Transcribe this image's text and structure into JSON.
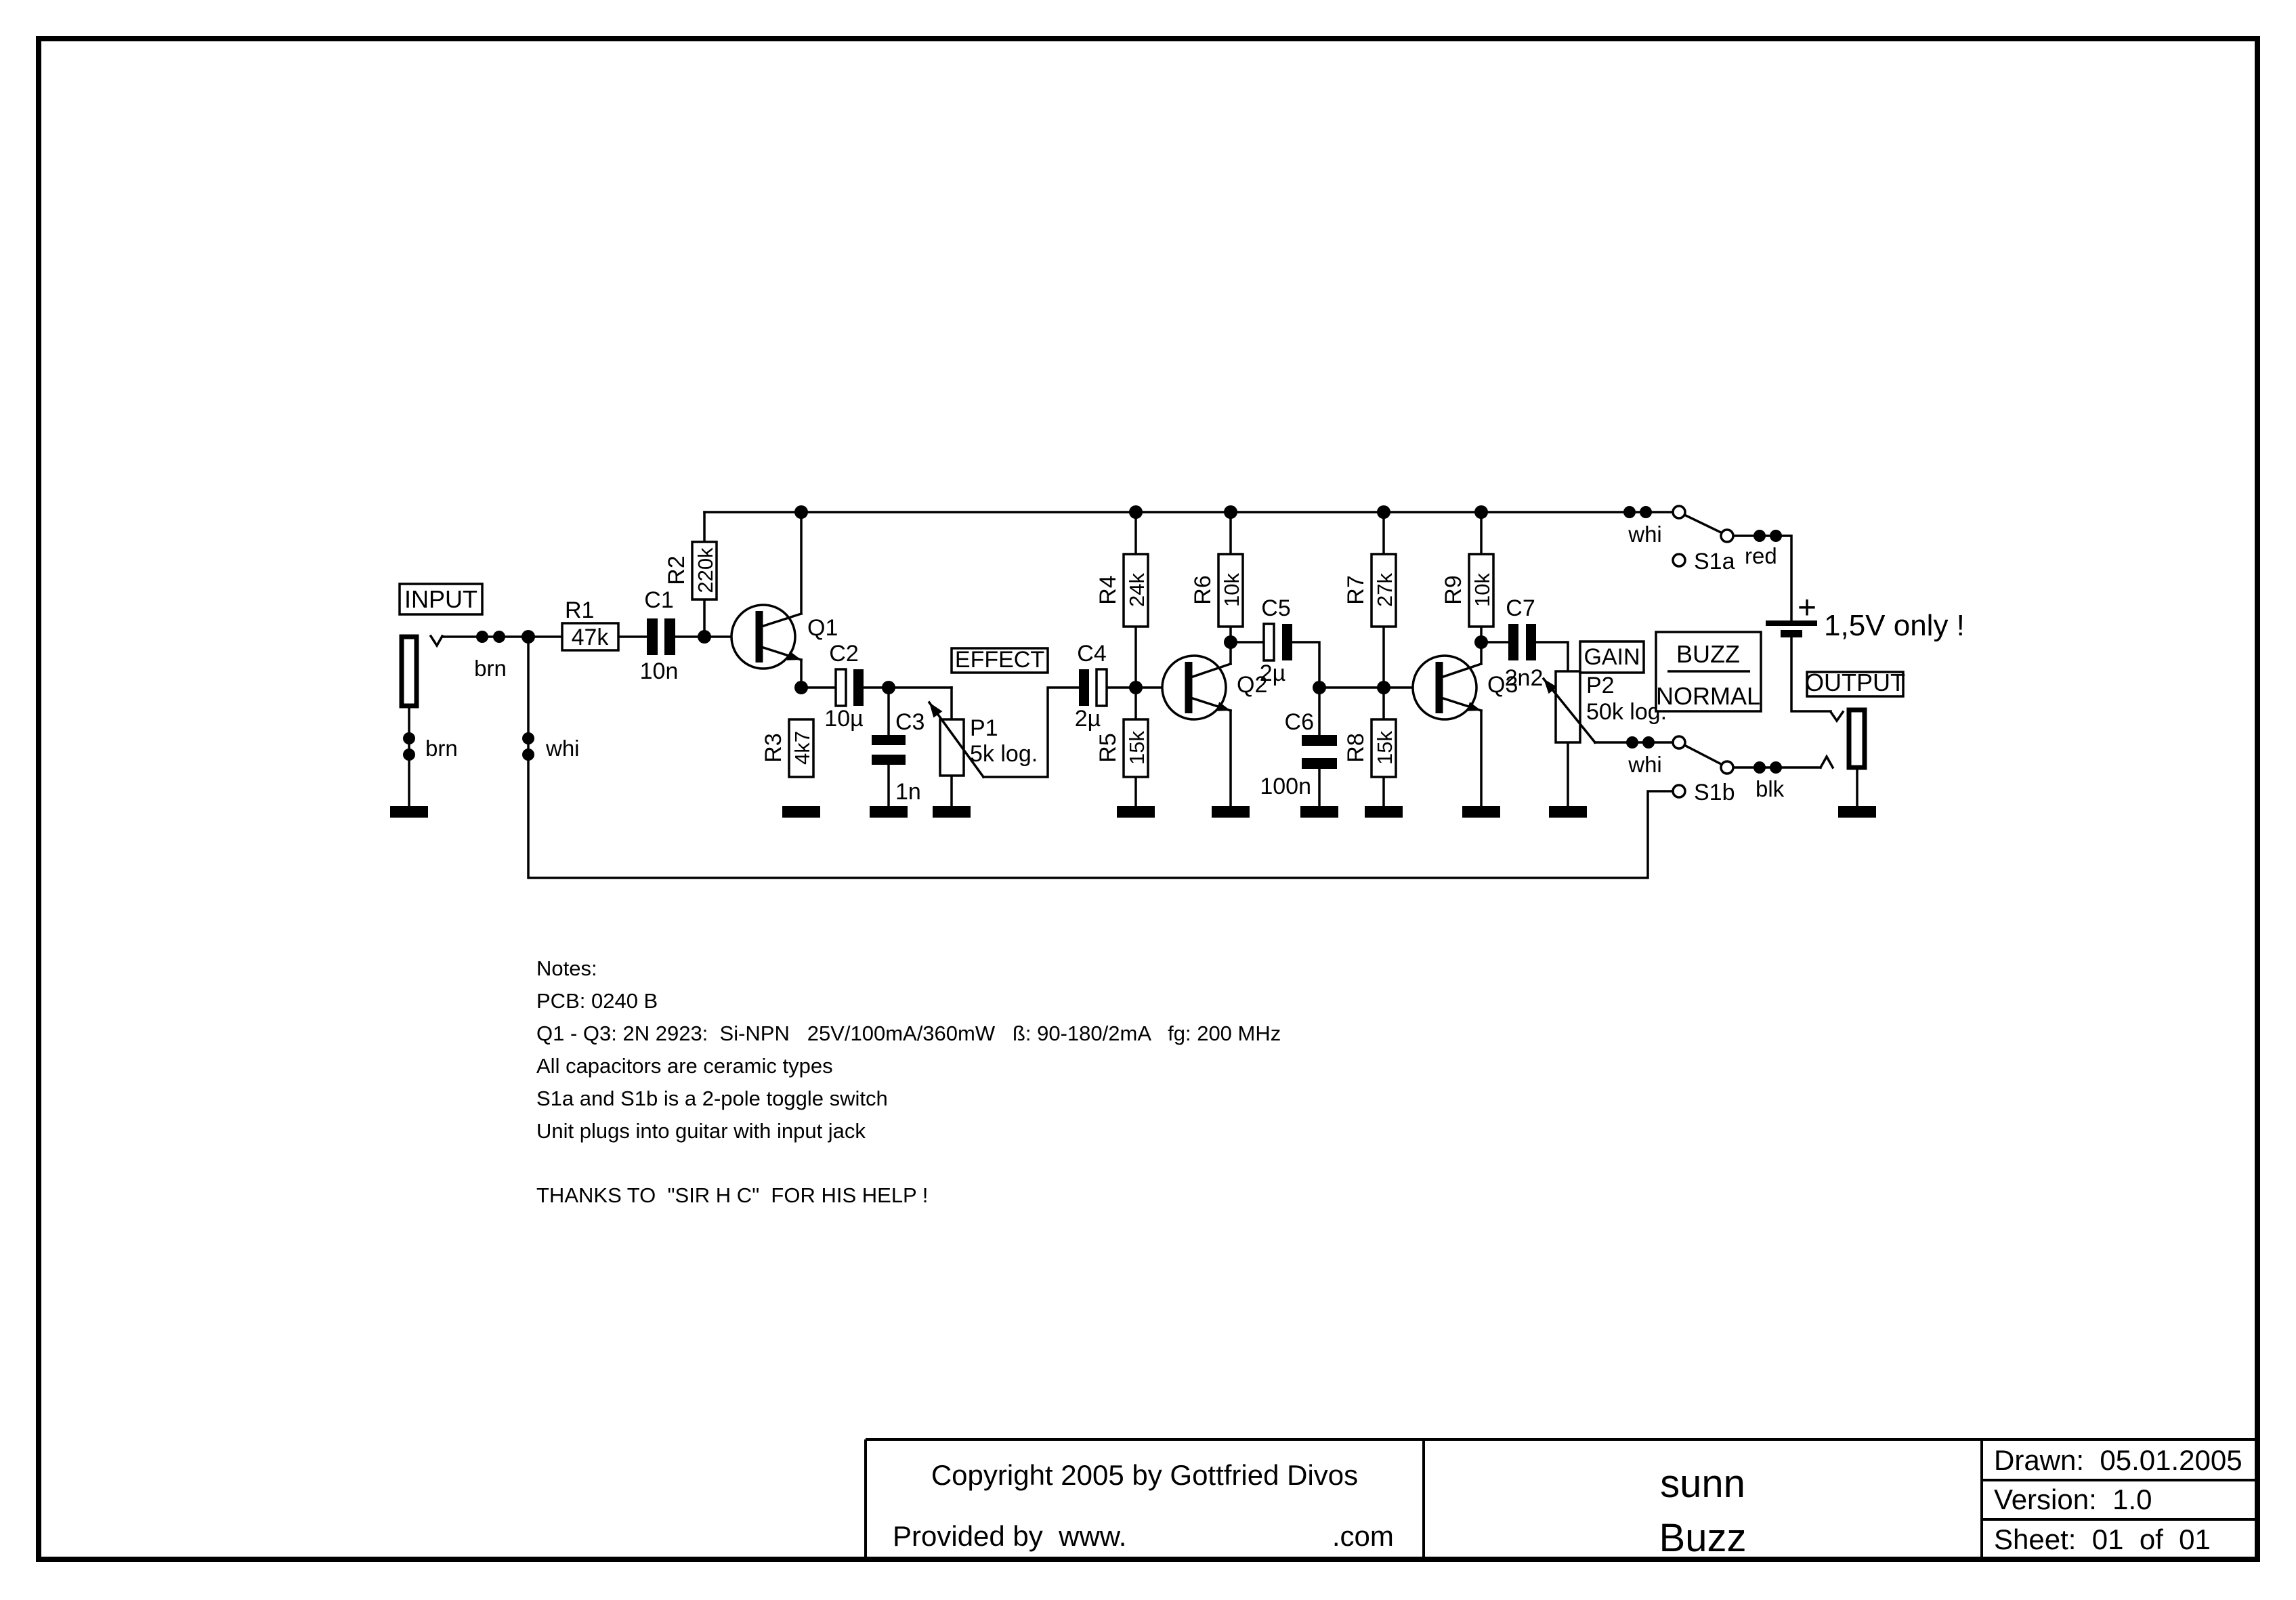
{
  "page": {
    "background": "#ffffff",
    "ink": "#000000"
  },
  "labels": {
    "input": "INPUT",
    "output": "OUTPUT",
    "effect": "EFFECT",
    "gain": "GAIN",
    "buzz": "BUZZ",
    "normal": "NORMAL",
    "battery_plus": "+",
    "battery_note": "1,5V only !"
  },
  "wire_labels": {
    "brn_top": "brn",
    "brn_gnd": "brn",
    "whi_in": "whi",
    "whi_s1a": "whi",
    "red": "red",
    "whi_s1b": "whi",
    "blk": "blk"
  },
  "switches": {
    "s1a": "S1a",
    "s1b": "S1b"
  },
  "components": {
    "r1": {
      "ref": "R1",
      "value": "47k"
    },
    "r2": {
      "ref": "R2",
      "value": "220k"
    },
    "r3": {
      "ref": "R3",
      "value": "4k7"
    },
    "r4": {
      "ref": "R4",
      "value": "24k"
    },
    "r5": {
      "ref": "R5",
      "value": "15k"
    },
    "r6": {
      "ref": "R6",
      "value": "10k"
    },
    "r7": {
      "ref": "R7",
      "value": "27k"
    },
    "r8": {
      "ref": "R8",
      "value": "15k"
    },
    "r9": {
      "ref": "R9",
      "value": "10k"
    },
    "c1": {
      "ref": "C1",
      "value": "10n"
    },
    "c2": {
      "ref": "C2",
      "value": "10µ"
    },
    "c3": {
      "ref": "C3",
      "value": "1n"
    },
    "c4": {
      "ref": "C4",
      "value": "2µ"
    },
    "c5": {
      "ref": "C5",
      "value": "2µ"
    },
    "c6": {
      "ref": "C6",
      "value": "100n"
    },
    "c7": {
      "ref": "C7",
      "value": "2n2"
    },
    "p1": {
      "ref": "P1",
      "value": "5k log."
    },
    "p2": {
      "ref": "P2",
      "value": "50k log."
    },
    "q1": {
      "ref": "Q1"
    },
    "q2": {
      "ref": "Q2"
    },
    "q3": {
      "ref": "Q3"
    }
  },
  "notes": {
    "heading": "Notes:",
    "lines": [
      "PCB: 0240 B",
      "Q1 - Q3: 2N 2923:  Si-NPN   25V/100mA/360mW   ß: 90-180/2mA   fg: 200 MHz",
      "All capacitors are ceramic types",
      "S1a and S1b is a 2-pole toggle switch",
      "Unit plugs into guitar with input jack"
    ],
    "thanks": "THANKS TO  \"SIR H C\"  FOR HIS HELP !"
  },
  "titleblock": {
    "copyright": "Copyright 2005 by Gottfried Divos",
    "provided": "Provided by  www.                          .com",
    "product_line1": "sunn",
    "product_line2": "Buzz",
    "drawn": "Drawn:  05.01.2005",
    "version": "Version:  1.0",
    "sheet": "Sheet:  01  of  01"
  }
}
